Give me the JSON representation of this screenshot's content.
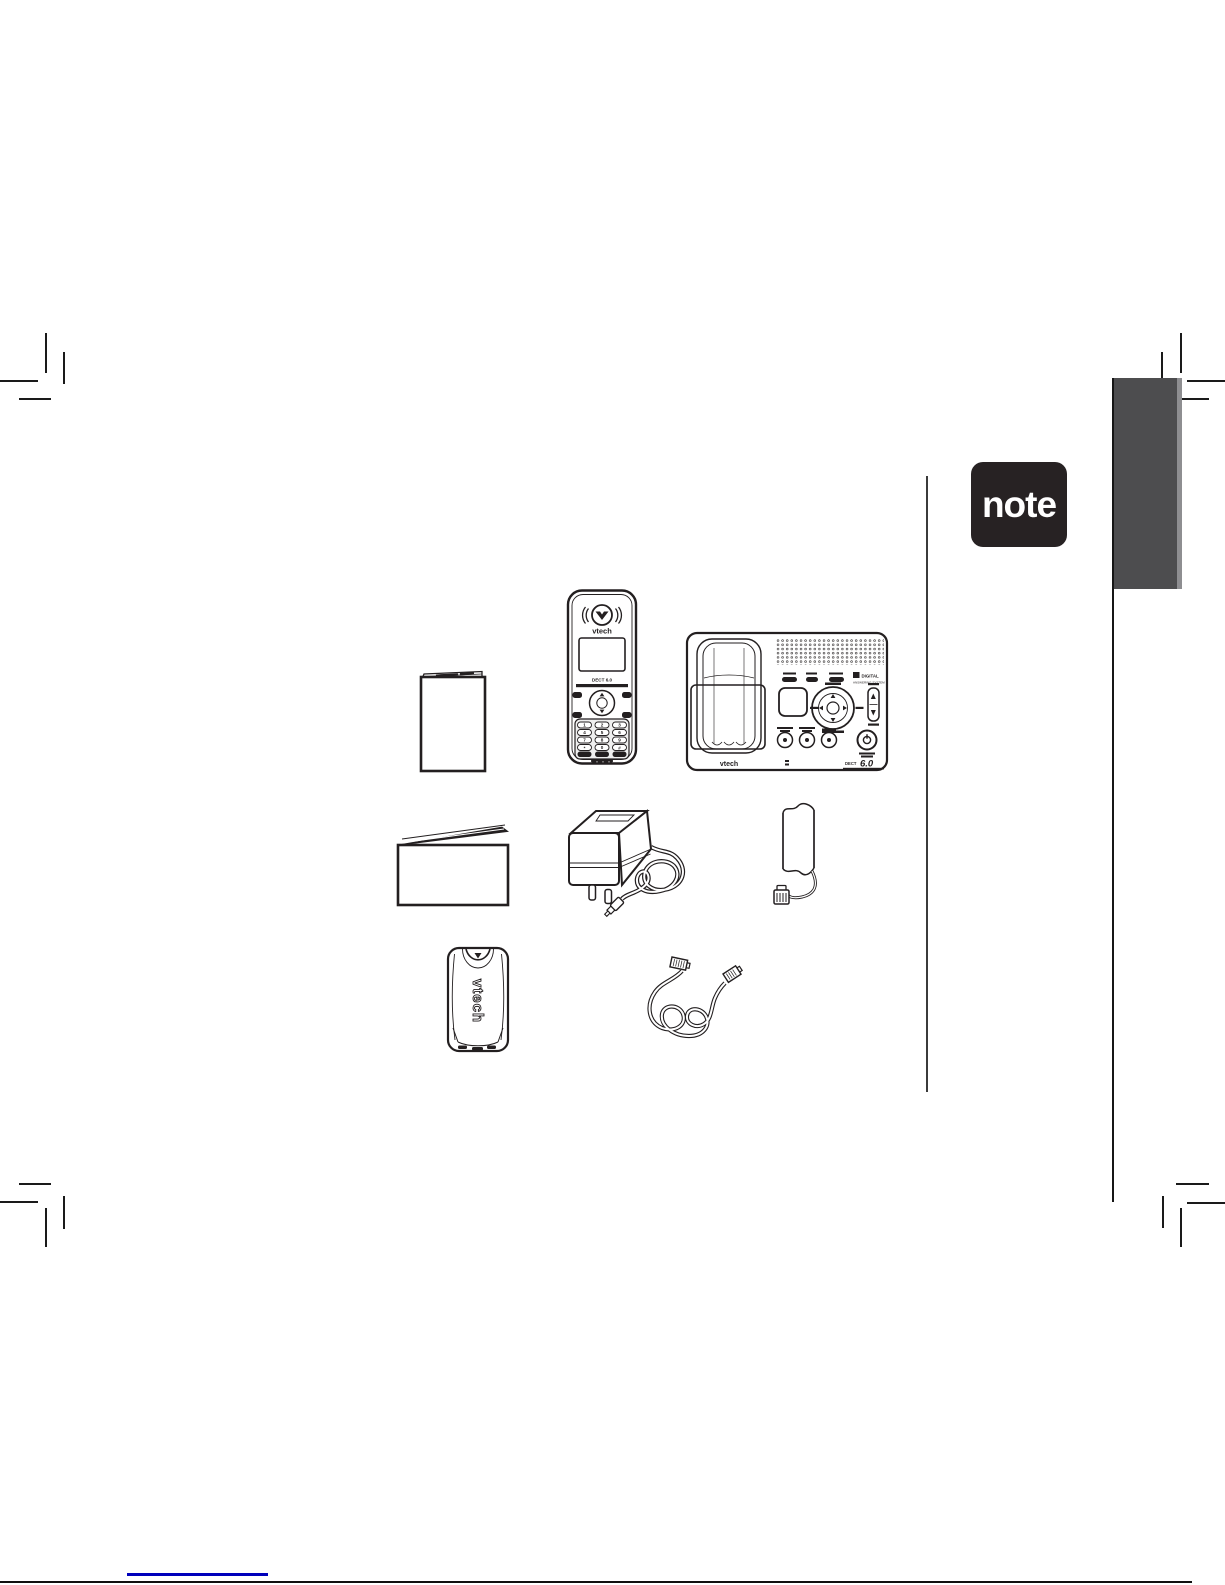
{
  "colors": {
    "ink": "#231f20",
    "side_tab": "#4d4d4f",
    "note_badge_bg": "#272223",
    "footer_line_blue": "#0000bb"
  },
  "note_badge": {
    "label": "note"
  },
  "package_contents": {
    "handset": {
      "brand": "vtech",
      "display_label": "DECT 6.0",
      "keypad": [
        "1",
        "2",
        "3",
        "4",
        "5",
        "6",
        "7",
        "8",
        "9",
        "*",
        "0",
        "#"
      ]
    },
    "telephone_base": {
      "brand": "vtech",
      "logo_line1": "DIGITAL",
      "logo_line2": "ANSWERING SYSTEM",
      "dect_prefix": "DECT",
      "dect_number": "6.0"
    },
    "battery_cover": {
      "brand": "vtech"
    }
  }
}
